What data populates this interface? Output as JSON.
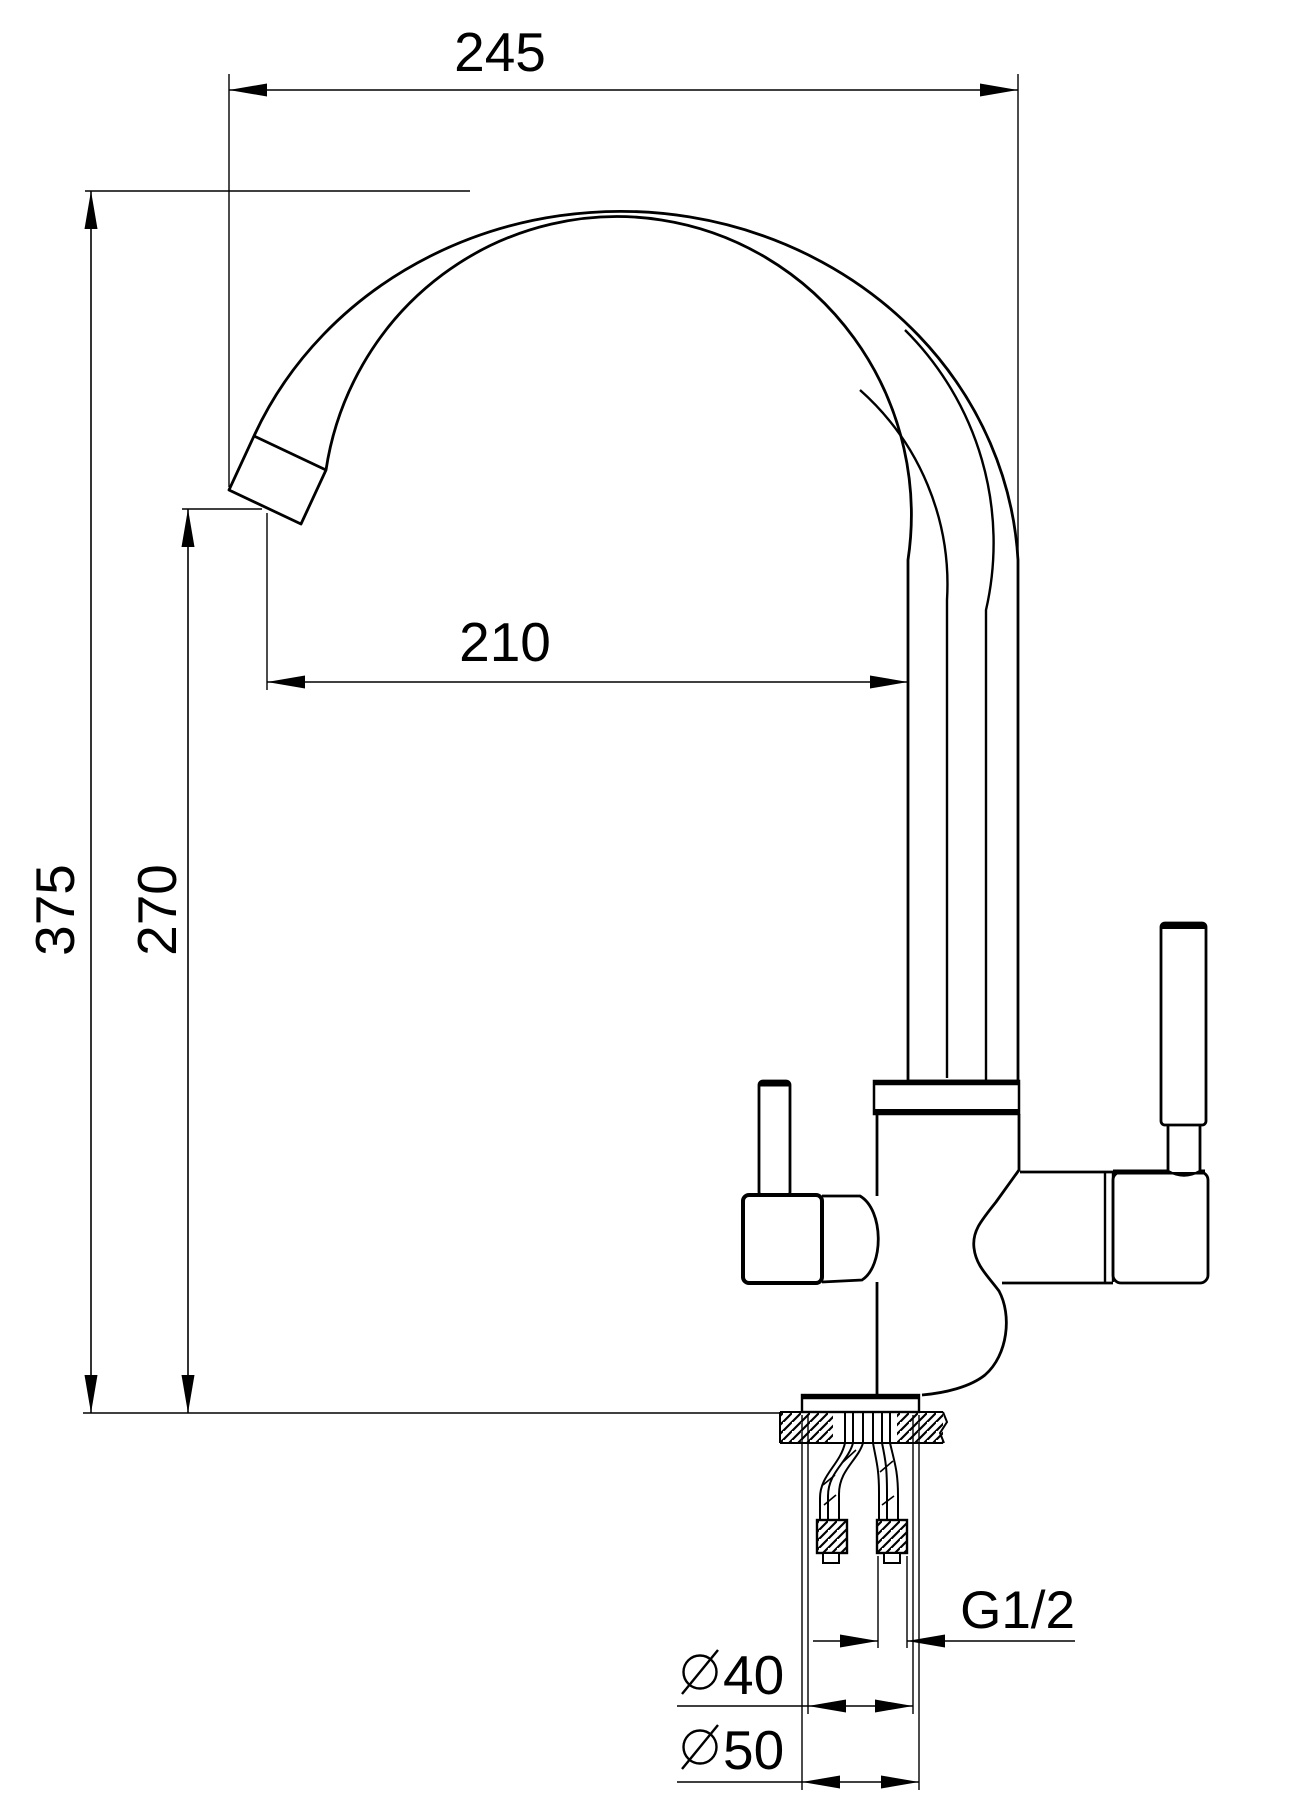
{
  "drawing": {
    "title": "faucet-dimension-drawing",
    "background_color": "#ffffff",
    "line_color": "#000000",
    "dimensions": {
      "overall_reach": {
        "label": "245"
      },
      "overall_height": {
        "label": "375"
      },
      "spout_outlet_height": {
        "label": "270"
      },
      "spout_reach": {
        "label": "210"
      },
      "connection_thread": {
        "label": "G1/2"
      },
      "body_diameter": {
        "symbol": "⌀",
        "label": "40"
      },
      "base_diameter": {
        "symbol": "⌀",
        "label": "50"
      }
    }
  }
}
